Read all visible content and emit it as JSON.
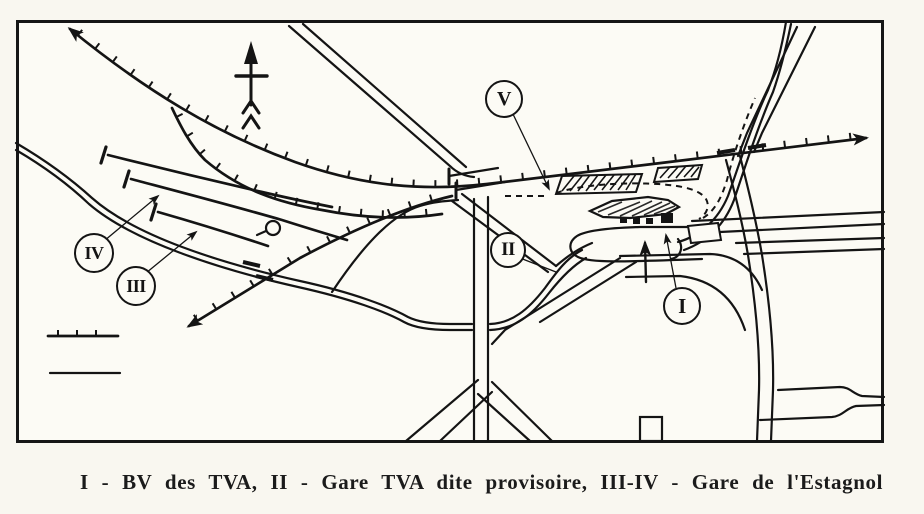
{
  "caption": {
    "text": "I - BV des TVA, II - Gare TVA dite provisoire, III-IV - Gare de l'Estagnol"
  },
  "markers": {
    "m1": "I",
    "m2": "II",
    "m3": "III",
    "m4": "IV",
    "m5": "V"
  },
  "legend": {
    "items": [
      {
        "name": "railway-ticked-line-symbol"
      },
      {
        "name": "plain-road-line-symbol"
      }
    ]
  },
  "icons": {
    "compass": "north-arrow"
  },
  "colors": {
    "ink": "#141414",
    "paper": "#fcfbf5"
  }
}
